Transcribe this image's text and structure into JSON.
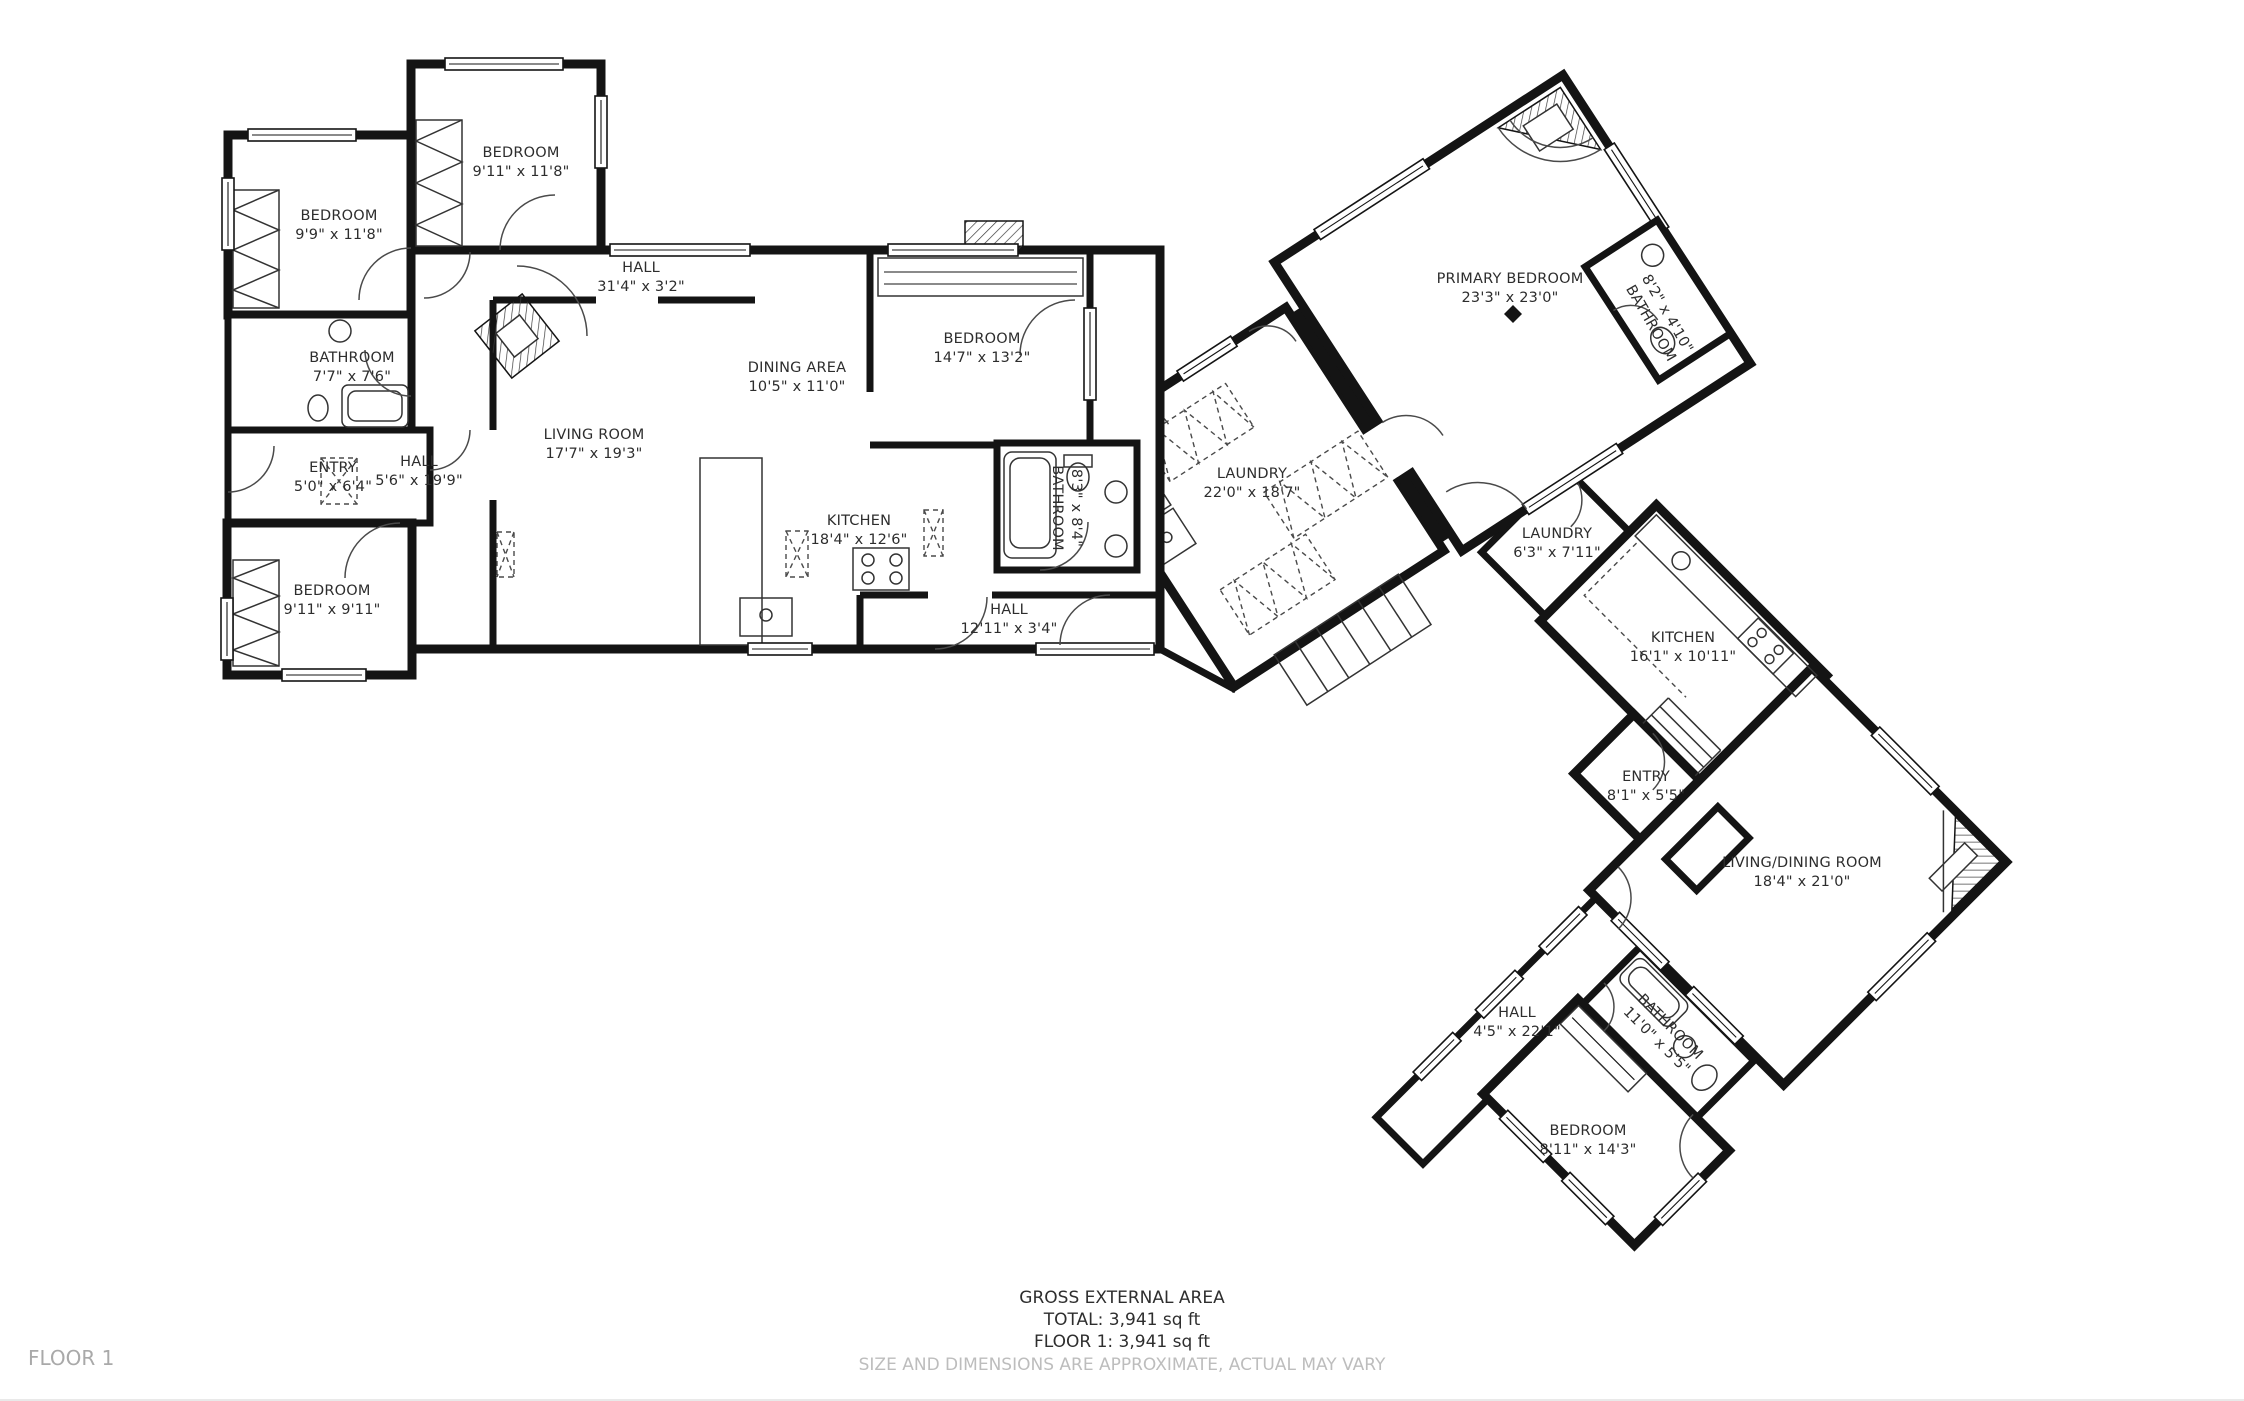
{
  "plan": {
    "rooms": [
      {
        "name": "BEDROOM",
        "dims": "9'11\" x 11'8\""
      },
      {
        "name": "BEDROOM",
        "dims": "9'9\" x 11'8\""
      },
      {
        "name": "HALL",
        "dims": "31'4\" x 3'2\""
      },
      {
        "name": "BATHROOM",
        "dims": "7'7\" x 7'6\""
      },
      {
        "name": "ENTRY",
        "dims": "5'0\" x 6'4\""
      },
      {
        "name": "HALL",
        "dims": "5'6\" x 19'9\""
      },
      {
        "name": "LIVING ROOM",
        "dims": "17'7\" x 19'3\""
      },
      {
        "name": "DINING AREA",
        "dims": "10'5\" x 11'0\""
      },
      {
        "name": "BEDROOM",
        "dims": "14'7\" x 13'2\""
      },
      {
        "name": "BATHROOM",
        "dims": "8'3\" x 8'4\""
      },
      {
        "name": "KITCHEN",
        "dims": "18'4\" x 12'6\""
      },
      {
        "name": "HALL",
        "dims": "12'11\" x 3'4\""
      },
      {
        "name": "BEDROOM",
        "dims": "9'11\" x 9'11\""
      },
      {
        "name": "LAUNDRY",
        "dims": "22'0\" x 18'7\""
      },
      {
        "name": "PRIMARY BEDROOM",
        "dims": "23'3\" x 23'0\""
      },
      {
        "name": "BATHROOM",
        "dims": "8'2\" x 4'10\""
      },
      {
        "name": "LAUNDRY",
        "dims": "6'3\" x 7'11\""
      },
      {
        "name": "KITCHEN",
        "dims": "16'1\" x 10'11\""
      },
      {
        "name": "ENTRY",
        "dims": "8'1\" x 5'5\""
      },
      {
        "name": "LIVING/DINING ROOM",
        "dims": "18'4\" x 21'0\""
      },
      {
        "name": "HALL",
        "dims": "4'5\" x 22'1\""
      },
      {
        "name": "BATHROOM",
        "dims": "11'0\" x 5'5\""
      },
      {
        "name": "BEDROOM",
        "dims": "8'11\" x 14'3\""
      }
    ],
    "footer": {
      "area_heading": "GROSS EXTERNAL AREA",
      "total": "TOTAL: 3,941 sq ft",
      "floor1": "FLOOR 1: 3,941 sq ft",
      "disclaimer": "SIZE AND DIMENSIONS ARE APPROXIMATE, ACTUAL MAY VARY"
    },
    "floor_label": "FLOOR 1",
    "colors": {
      "walls": "#141414",
      "label_text": "#2d2d2d",
      "muted_text": "#bdbdbd",
      "background": "#ffffff"
    }
  }
}
